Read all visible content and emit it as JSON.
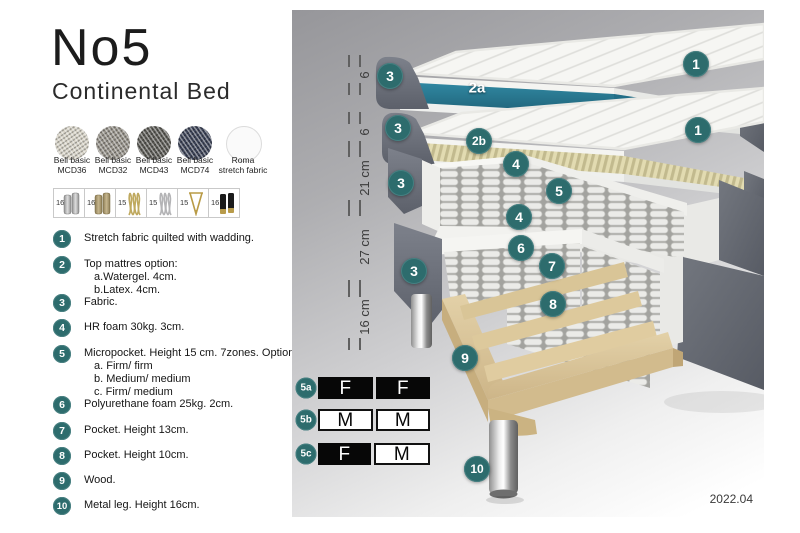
{
  "brand": {
    "title": "No5",
    "subtitle": "Continental Bed"
  },
  "colors": {
    "badge_teal": "#2d6c6d",
    "watergel_teal": "#277a93",
    "latex_cream": "#ded7ac",
    "fabric_gray": "#676b75",
    "wood_tan": "#dcc79c",
    "firmness_black": "#070707"
  },
  "fabric_swatches": [
    {
      "name": "Bell basic",
      "code": "MCD36"
    },
    {
      "name": "Bell basic",
      "code": "MCD32"
    },
    {
      "name": "Bell basic",
      "code": "MCD43"
    },
    {
      "name": "Bell basic",
      "code": "MCD74"
    },
    {
      "name": "Roma",
      "code": "stretch fabric"
    }
  ],
  "leg_options": [
    {
      "height": "16",
      "icon": "cylinder-silver-leg-icon"
    },
    {
      "height": "16",
      "icon": "cylinder-bronze-leg-icon"
    },
    {
      "height": "15",
      "icon": "twisted-gold-leg-icon"
    },
    {
      "height": "15",
      "icon": "twisted-silver-leg-icon"
    },
    {
      "height": "15",
      "icon": "hairpin-gold-leg-icon"
    },
    {
      "height": "16",
      "icon": "cylinder-black-gold-leg-icon"
    }
  ],
  "legend": [
    {
      "num": "1",
      "text": "Stretch fabric quilted with wadding."
    },
    {
      "num": "2",
      "text": "Top mattres option:",
      "sub_a": "a.Watergel. 4cm.",
      "sub_b": "b.Latex. 4cm."
    },
    {
      "num": "3",
      "text": "Fabric."
    },
    {
      "num": "4",
      "text": "HR foam 30kg. 3cm."
    },
    {
      "num": "5",
      "text": "Micropocket. Height 15 cm. 7zones. Option:",
      "sub_a": "a. Firm/ firm",
      "sub_b": "b. Medium/ medium",
      "sub_c": "c. Firm/ medium"
    },
    {
      "num": "6",
      "text": "Polyurethane foam 25kg. 2cm."
    },
    {
      "num": "7",
      "text": "Pocket. Height 13cm."
    },
    {
      "num": "8",
      "text": "Pocket. Height 10cm."
    },
    {
      "num": "9",
      "text": "Wood."
    },
    {
      "num": "10",
      "text": "Metal leg. Height 16cm."
    }
  ],
  "diagram": {
    "badges": [
      {
        "label": "3"
      },
      {
        "label": "2a"
      },
      {
        "label": "1"
      },
      {
        "label": "3"
      },
      {
        "label": "2b"
      },
      {
        "label": "1"
      },
      {
        "label": "4"
      },
      {
        "label": "5"
      },
      {
        "label": "4"
      },
      {
        "label": "3"
      },
      {
        "label": "6"
      },
      {
        "label": "7"
      },
      {
        "label": "8"
      },
      {
        "label": "3"
      },
      {
        "label": "9"
      },
      {
        "label": "10"
      }
    ],
    "ruler": [
      {
        "label": "6"
      },
      {
        "label": "6"
      },
      {
        "label": "21 cm"
      },
      {
        "label": "27 cm"
      },
      {
        "label": "16 cm"
      }
    ],
    "version": "2022.04"
  },
  "firmness": {
    "rows": [
      {
        "id": "5a",
        "cells": [
          {
            "letter": "F"
          },
          {
            "letter": "F"
          }
        ]
      },
      {
        "id": "5b",
        "cells": [
          {
            "letter": "M"
          },
          {
            "letter": "M"
          }
        ]
      },
      {
        "id": "5c",
        "cells": [
          {
            "letter": "F"
          },
          {
            "letter": "M"
          }
        ]
      }
    ]
  }
}
